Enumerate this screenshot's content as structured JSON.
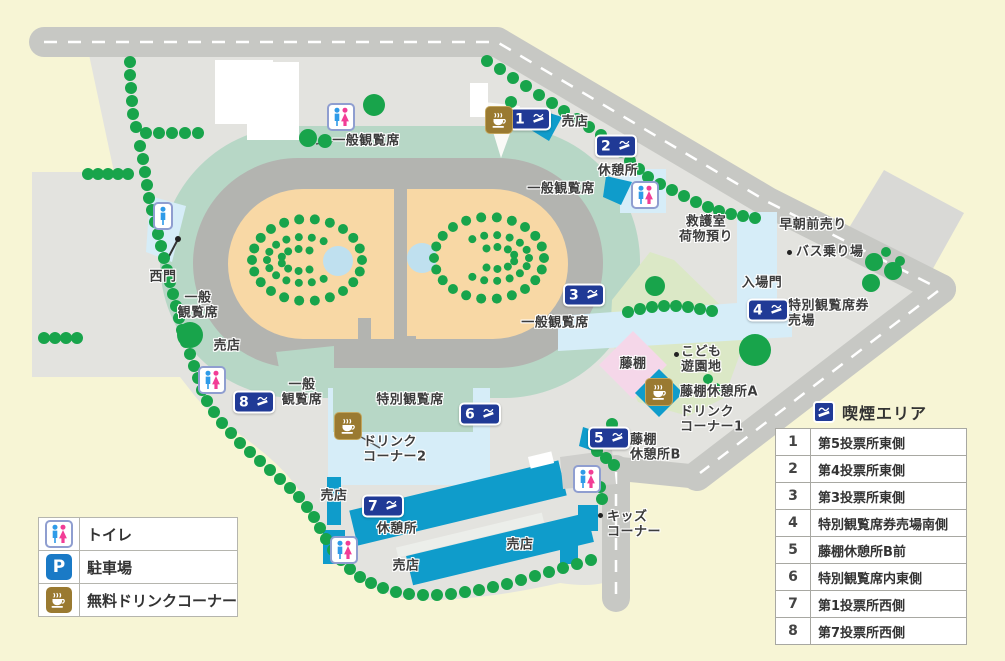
{
  "map": {
    "smoking_badges": [
      "1",
      "2",
      "3",
      "4",
      "5",
      "6",
      "7",
      "8"
    ],
    "labels": [
      {
        "id": "gen-nw",
        "text": "一般観覧席"
      },
      {
        "id": "shop-n",
        "text": "売店"
      },
      {
        "id": "rest-ne",
        "text": "休憩所"
      },
      {
        "id": "gen-ne",
        "text": "一般観覧席"
      },
      {
        "id": "firstaid",
        "text": "救護室\n荷物預り"
      },
      {
        "id": "early-sales",
        "text": "早朝前売り"
      },
      {
        "id": "bus-stop",
        "text": "バス乗り場"
      },
      {
        "id": "entrance-gate",
        "text": "入場門"
      },
      {
        "id": "special-ticket",
        "text": "特別観覧席券\n売場"
      },
      {
        "id": "gen-e",
        "text": "一般観覧席"
      },
      {
        "id": "wisteria",
        "text": "藤棚"
      },
      {
        "id": "kids-park",
        "text": "こども\n遊園地"
      },
      {
        "id": "wisteria-rest-a",
        "text": "藤棚休憩所A"
      },
      {
        "id": "drink-corner-1",
        "text": "ドリンク\nコーナー1"
      },
      {
        "id": "wisteria-rest-b",
        "text": "藤棚\n休憩所B"
      },
      {
        "id": "gen-w",
        "text": "一般\n観覧席"
      },
      {
        "id": "west-gate",
        "text": "西門"
      },
      {
        "id": "shop-w",
        "text": "売店"
      },
      {
        "id": "gen-sw",
        "text": "一般\n観覧席"
      },
      {
        "id": "special-stand",
        "text": "特別観覧席"
      },
      {
        "id": "drink-corner-2",
        "text": "ドリンク\nコーナー2"
      },
      {
        "id": "shop-s1",
        "text": "売店"
      },
      {
        "id": "rest-s",
        "text": "休憩所"
      },
      {
        "id": "shop-s2",
        "text": "売店"
      },
      {
        "id": "shop-s3",
        "text": "売店"
      },
      {
        "id": "kids-corner",
        "text": "キッズ\nコーナー"
      }
    ],
    "colors": {
      "tree_green": "#18a44b",
      "building_cyan": "#0f9ccb",
      "badge_navy": "#203a96",
      "coffee_gold": "#9a7a31",
      "toilet_blue": "#2f9be8",
      "toilet_pink": "#f23d96",
      "parking_blue": "#1a7ac6",
      "infield_tan": "#f8d8a5",
      "stand_teal": "#b7d7c6",
      "walkway_blue": "#d6edf8",
      "park_green": "#dbe8c6",
      "wisteria_pink": "#f5d7e9"
    }
  },
  "legend_facilities": {
    "parking_letter": "P",
    "rows": [
      {
        "icon": "toilet-icon",
        "label": "トイレ"
      },
      {
        "icon": "parking-icon",
        "label": "駐車場"
      },
      {
        "icon": "drink-icon",
        "label": "無料ドリンクコーナー"
      }
    ]
  },
  "legend_smoking": {
    "title": "喫煙エリア",
    "rows": [
      {
        "num": "1",
        "label": "第5投票所東側"
      },
      {
        "num": "2",
        "label": "第4投票所東側"
      },
      {
        "num": "3",
        "label": "第3投票所東側"
      },
      {
        "num": "4",
        "label": "特別観覧席券売場南側"
      },
      {
        "num": "5",
        "label": "藤棚休憩所B前"
      },
      {
        "num": "6",
        "label": "特別観覧席内東側"
      },
      {
        "num": "7",
        "label": "第1投票所西側"
      },
      {
        "num": "8",
        "label": "第7投票所西側"
      }
    ]
  }
}
